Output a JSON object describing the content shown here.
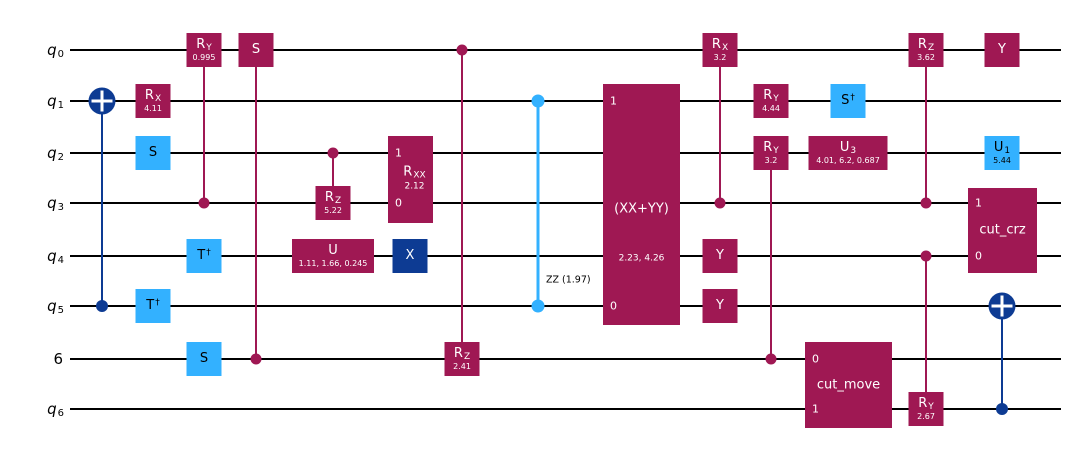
{
  "figure": {
    "type": "quantum circuit diagram",
    "num_wires": 8
  },
  "colors": {
    "gate_crimson": "#9F1853",
    "gate_cyan": "#33B1FF",
    "gate_navy": "#0D3B93",
    "wire": "#000000",
    "background": "#FFFFFF"
  },
  "wires": [
    {
      "label": "q",
      "sub": "0"
    },
    {
      "label": "q",
      "sub": "1"
    },
    {
      "label": "q",
      "sub": "2"
    },
    {
      "label": "q",
      "sub": "3"
    },
    {
      "label": "q",
      "sub": "4"
    },
    {
      "label": "q",
      "sub": "5"
    },
    {
      "label": "6",
      "sub": ""
    },
    {
      "label": "q",
      "sub": "6"
    }
  ],
  "gates": {
    "rx_q1": {
      "name": "R",
      "sub": "X",
      "param": "4.11"
    },
    "s_q2": {
      "name": "S"
    },
    "tdg_q5": {
      "name": "T",
      "sup": "†"
    },
    "cry0995_q0": {
      "name": "R",
      "sub": "Y",
      "param": "0.995"
    },
    "tdg_q4": {
      "name": "T",
      "sup": "†"
    },
    "s_w6": {
      "name": "S"
    },
    "cs_q0": {
      "name": "S"
    },
    "crz522_q3": {
      "name": "R",
      "sub": "Z",
      "param": "5.22"
    },
    "u_q4": {
      "name": "U",
      "param": "1.11, 1.66, 0.245"
    },
    "rxx": {
      "name": "R",
      "sub": "XX",
      "param": "2.12",
      "top_index": "1",
      "bottom_index": "0"
    },
    "x_q4": {
      "name": "X"
    },
    "crz241_w6": {
      "name": "R",
      "sub": "Z",
      "param": "2.41"
    },
    "zz": {
      "label": "ZZ (1.97)"
    },
    "xxyy": {
      "name": "(XX+YY)",
      "param": "2.23, 4.26",
      "top_index": "1",
      "bottom_index": "0"
    },
    "crx32_q0": {
      "name": "R",
      "sub": "X",
      "param": "3.2"
    },
    "y_q4": {
      "name": "Y"
    },
    "y_q5": {
      "name": "Y"
    },
    "ry444_q1": {
      "name": "R",
      "sub": "Y",
      "param": "4.44"
    },
    "cry32_q2": {
      "name": "R",
      "sub": "Y",
      "param": "3.2"
    },
    "sdg_q1": {
      "name": "S",
      "sup": "†"
    },
    "u3_q2": {
      "name": "U",
      "sub": "3",
      "param": "4.01, 6.2, 0.687"
    },
    "cut_move": {
      "name": "cut_move",
      "top_index": "0",
      "bottom_index": "1"
    },
    "crz362_q0": {
      "name": "R",
      "sub": "Z",
      "param": "3.62"
    },
    "cry267_q6": {
      "name": "R",
      "sub": "Y",
      "param": "2.67"
    },
    "y_q0": {
      "name": "Y"
    },
    "u1_q2": {
      "name": "U",
      "sub": "1",
      "param": "5.44"
    },
    "cut_crz": {
      "name": "cut_crz",
      "top_index": "1",
      "bottom_index": "0"
    }
  },
  "connections": [
    {
      "type": "cx",
      "control": "q5",
      "target": "q1"
    },
    {
      "type": "controlled",
      "gate": "RY(0.995)",
      "control": "q3",
      "target": "q0"
    },
    {
      "type": "controlled",
      "gate": "S",
      "control": "6",
      "target": "q0"
    },
    {
      "type": "controlled",
      "gate": "RZ(5.22)",
      "control": "q2",
      "target": "q3"
    },
    {
      "type": "controlled",
      "gate": "RZ(2.41)",
      "control": "q0",
      "target": "6"
    },
    {
      "type": "zz",
      "label": "ZZ (1.97)",
      "qubits": [
        "q1",
        "q5"
      ]
    },
    {
      "type": "controlled",
      "gate": "RX(3.2)",
      "control": "q3",
      "target": "q0"
    },
    {
      "type": "controlled",
      "gate": "RY(3.2)",
      "control": "6",
      "target": "q2"
    },
    {
      "type": "controlled",
      "gate": "RZ(3.62)",
      "control": "q3",
      "target": "q0"
    },
    {
      "type": "controlled",
      "gate": "RY(2.67)",
      "control": "q4",
      "target": "q6"
    },
    {
      "type": "cx",
      "control": "q6",
      "target": "q5"
    }
  ]
}
